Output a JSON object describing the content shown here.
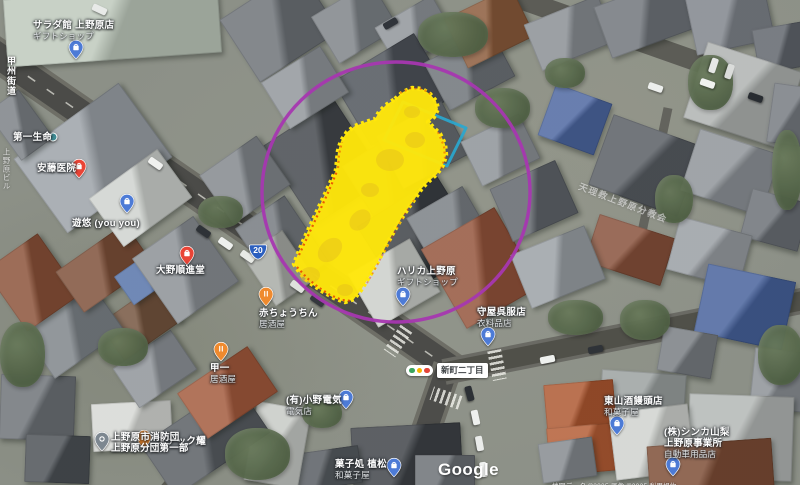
{
  "watermark": {
    "logo": "Google",
    "attribution": "地図データ ©2025  画像 ©2025  利用規約"
  },
  "roads": {
    "koshu_kaido": "甲州街道",
    "route_badge": "20",
    "intersection": "新町二丁目"
  },
  "faint_labels": {
    "roof_text": "天理教上野原分教会",
    "building_vertical": "上野原ビル"
  },
  "places": [
    {
      "name": "サラダ館 上野原店",
      "category": "ギフトショップ",
      "pin": "shopping-blue"
    },
    {
      "name": "第一生命",
      "pin": "dot-teal"
    },
    {
      "name": "安藤医院",
      "pin": "place-red"
    },
    {
      "name": "遊悠 (you you)",
      "pin": "shopping-blue"
    },
    {
      "name": "大野順進堂",
      "pin": "place-red"
    },
    {
      "name": "赤ちょうちん",
      "category": "居酒屋",
      "pin": "food-orange"
    },
    {
      "name": "甲一",
      "category": "居酒屋",
      "pin": "food-orange"
    },
    {
      "name": "ハリカ上野原",
      "category": "ギフトショップ",
      "pin": "shopping-blue"
    },
    {
      "name": "守屋呉服店",
      "category": "衣料品店",
      "pin": "shopping-blue"
    },
    {
      "name": "(有)小野電気",
      "category": "電気店",
      "pin": "shopping-blue"
    },
    {
      "name": "菓子処 植松",
      "category": "和菓子屋",
      "pin": "shopping-blue"
    },
    {
      "name": "東山酒饅頭店",
      "category": "和菓子屋",
      "pin": "shopping-blue"
    },
    {
      "name": "(株)シンカ山梨",
      "name2": "上野原事業所",
      "category": "自動車用品店",
      "pin": "shopping-blue"
    },
    {
      "name": "スナック耀",
      "pin": "food-orange"
    },
    {
      "name": "上野原市消防団",
      "name2": "上野原分団第一部",
      "pin": "civic-gray"
    }
  ],
  "annotations": {
    "circle_color": "#a637b0",
    "rect_color": "#2aa7cf",
    "highlight_color": "#ffe70a",
    "scribble_edge_color": "#e83a00"
  }
}
